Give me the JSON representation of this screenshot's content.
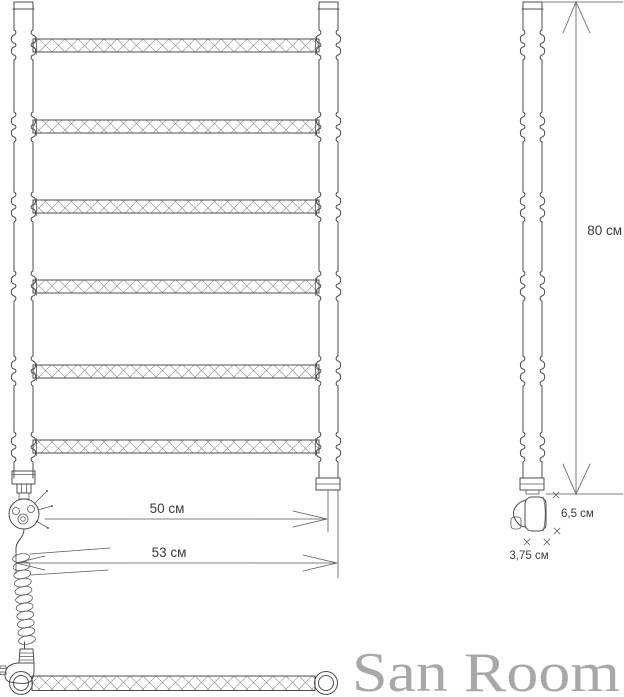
{
  "drawing": {
    "subject": "ladder towel rail with electric heating element - technical drawing",
    "rung_count": 6,
    "views": [
      "front-view",
      "side-view",
      "rung-detail"
    ],
    "parts": [
      "front-left-post",
      "front-right-post",
      "rung",
      "heating-element",
      "spiral-cable",
      "power-plug",
      "wall-bracket",
      "rung-detail-bar"
    ]
  },
  "dimensions": {
    "inner_width": {
      "label": "50 см"
    },
    "outer_width": {
      "label": "53 см"
    },
    "height": {
      "label": "80 см"
    },
    "wall_offset": {
      "label": "6,5 см"
    },
    "bracket_width": {
      "label": "3,75 см"
    }
  },
  "brand": {
    "name": "San Room"
  },
  "colors": {
    "line": "#4d4d4d",
    "hatch": "#999999",
    "dimension_text": "#3b3b3b",
    "watermark": "#a8a8a8",
    "background": "#ffffff"
  }
}
